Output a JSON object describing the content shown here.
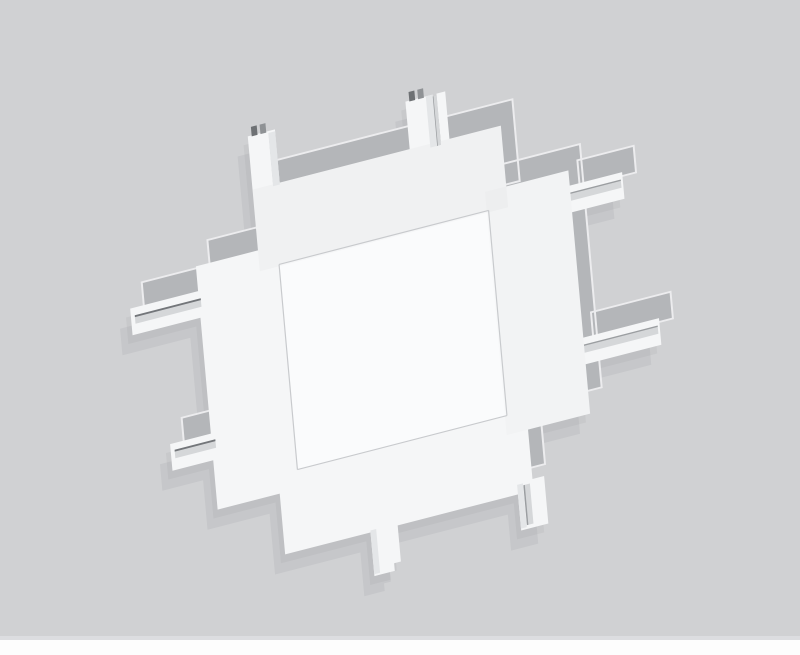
{
  "scene": {
    "alt_text": "White cross-shaped track lighting connector photographed from above on a light gray backdrop",
    "object_label": "X-shaped track connector",
    "backdrop_label": "gray studio backdrop with white strip at bottom"
  },
  "colors": {
    "background": "#d0d1d3",
    "backdrop_divider": "#dcdde0",
    "backdrop_strip": "#fdfdfd",
    "object_top": "#f5f6f7",
    "object_center": "#fafbfc",
    "object_side": "#b4b6b9",
    "rim_light": "#ececee",
    "seam": "#c8cacd",
    "groove": "#d5d7d9",
    "groove_dark": "#73767a",
    "groove_mid": "#9b9ea1",
    "prong_shade": "#e4e6e8",
    "pin_dark": "#6e7174",
    "pin_mid": "#8f9295",
    "shadow": "#1b1c1e"
  }
}
